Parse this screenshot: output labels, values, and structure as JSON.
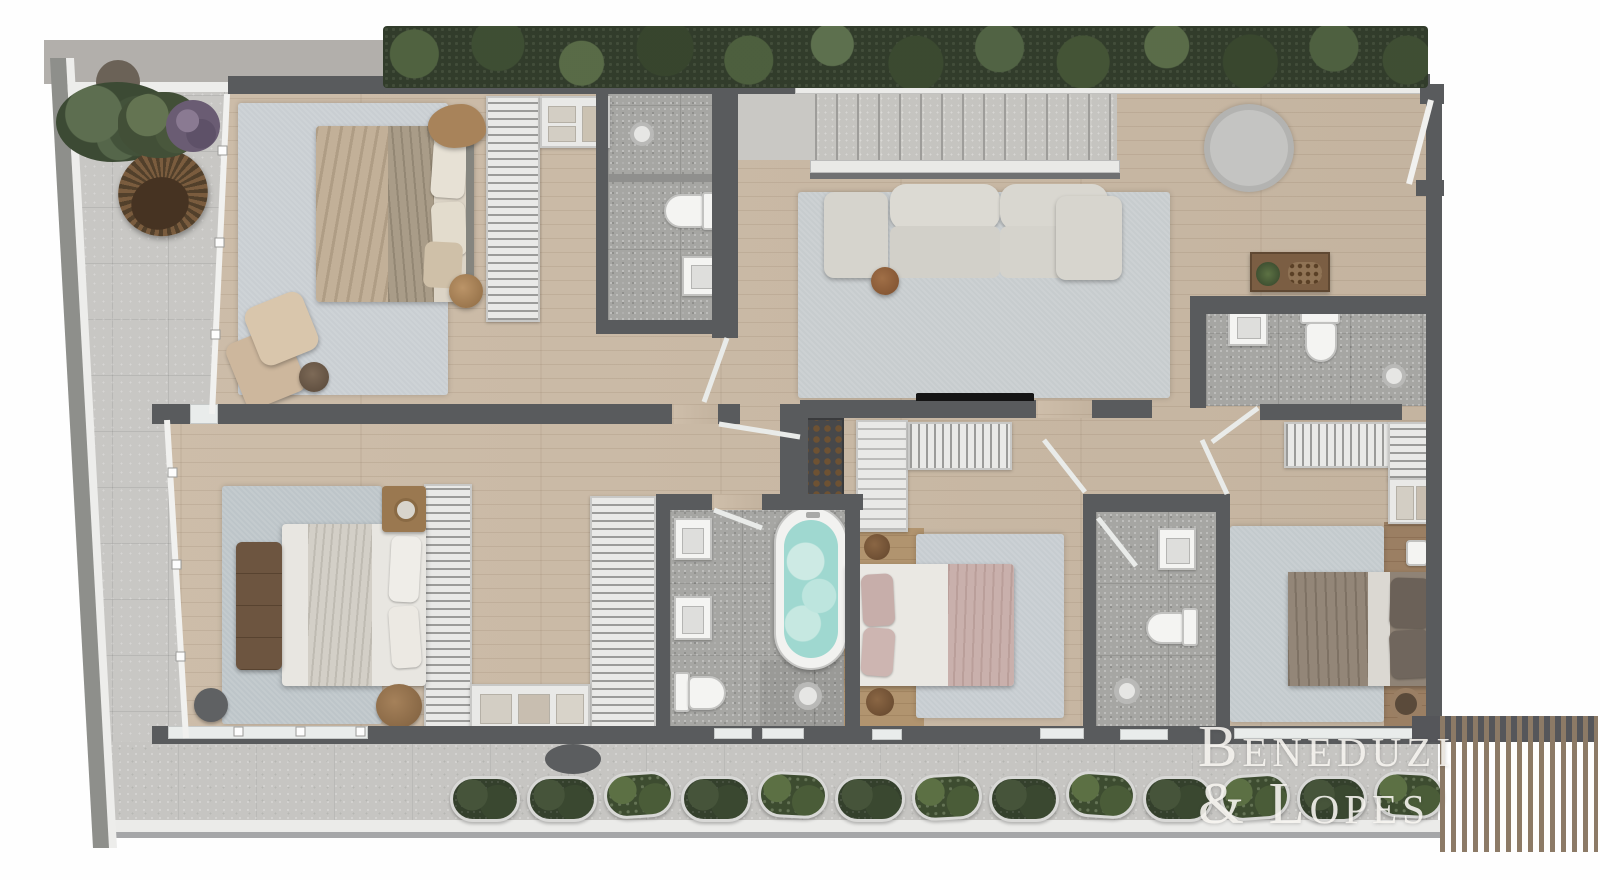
{
  "watermark": {
    "line1": "Beneduzi",
    "line2": "& Lopes"
  },
  "palette": {
    "wall": "#595b5d",
    "wood_floor": "#cbbaa5",
    "terrace_tile": "#c8c7c4",
    "bath_tile": "#a6a6a3",
    "rug_gray_blue": "#c7ccd0",
    "sofa": "#d7d5ce",
    "hedge_green": "#2c3627",
    "tub_water": "#9fd8d0",
    "furniture_wood": "#a07c52",
    "pergola_slat": "#8c7a66",
    "glass_rail": "#f1f1ef",
    "background": "#fefefe"
  },
  "icons": {
    "toilet": "toilet-icon",
    "sink": "sink-icon",
    "shower": "shower-head-icon",
    "bathtub": "bathtub-icon",
    "bed": "bed-icon",
    "sofa": "sofa-icon",
    "plant": "plant-icon"
  }
}
